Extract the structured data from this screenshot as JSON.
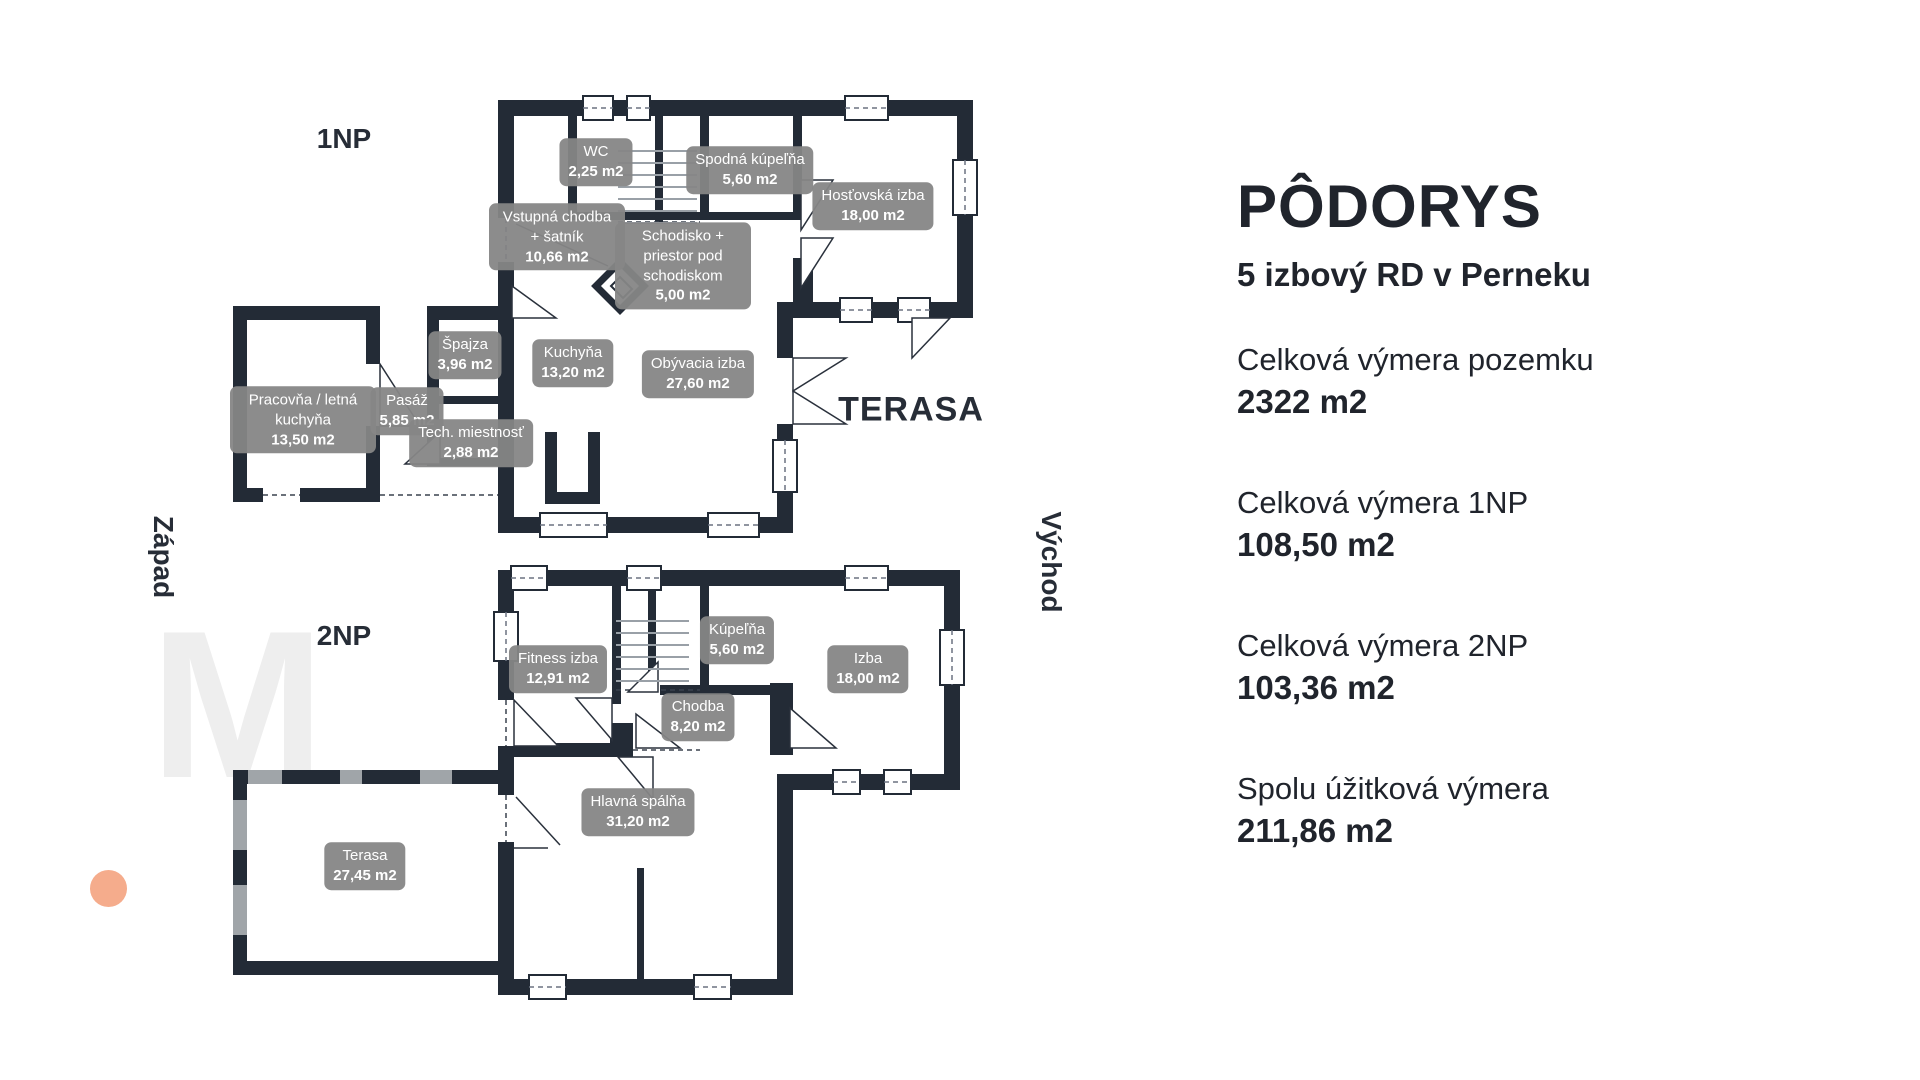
{
  "info_panel": {
    "title": "PÔDORYS",
    "subtitle": "5 izbový RD v Perneku",
    "stats": [
      {
        "label": "Celková výmera pozemku",
        "value": "2322 m2"
      },
      {
        "label": "Celková výmera 1NP",
        "value": "108,50 m2"
      },
      {
        "label": "Celková výmera 2NP",
        "value": "103,36 m2"
      },
      {
        "label": "Spolu úžitková výmera",
        "value": "211,86 m2"
      }
    ]
  },
  "floor1": {
    "name": "1NP",
    "terrace_label": "TERASA",
    "rooms": [
      {
        "name": "WC",
        "area": "2,25 m2"
      },
      {
        "name": "Spodná kúpeľňa",
        "area": "5,60 m2"
      },
      {
        "name": "Hosťovská izba",
        "area": "18,00 m2"
      },
      {
        "name": "Vstupná chodba + šatník",
        "area": "10,66 m2"
      },
      {
        "name": "Schodisko + priestor pod schodiskom",
        "area": "5,00 m2"
      },
      {
        "name": "Špajza",
        "area": "3,96 m2"
      },
      {
        "name": "Kuchyňa",
        "area": "13,20 m2"
      },
      {
        "name": "Obývacia izba",
        "area": "27,60 m2"
      },
      {
        "name": "Pasáž",
        "area": "5,85 m2"
      },
      {
        "name": "Pracovňa / letná kuchyňa",
        "area": "13,50 m2"
      },
      {
        "name": "Tech. miestnosť",
        "area": "2,88 m2"
      }
    ]
  },
  "floor2": {
    "name": "2NP",
    "rooms": [
      {
        "name": "Fitness izba",
        "area": "12,91 m2"
      },
      {
        "name": "Kúpeľňa",
        "area": "5,60 m2"
      },
      {
        "name": "Izba",
        "area": "18,00 m2"
      },
      {
        "name": "Chodba",
        "area": "8,20 m2"
      },
      {
        "name": "Hlavná spálňa",
        "area": "31,20 m2"
      },
      {
        "name": "Terasa",
        "area": "27,45 m2"
      }
    ]
  },
  "compass": {
    "west": "Západ",
    "east": "Východ"
  },
  "watermark_letter": "M",
  "colors": {
    "wall": "#232b36",
    "badge_bg": "#868686",
    "badge_text": "#ffffff",
    "text": "#20242c",
    "accent_dot": "#f5ac8c",
    "watermark": "#eeeeee",
    "stair_tread": "#99a0a7"
  }
}
